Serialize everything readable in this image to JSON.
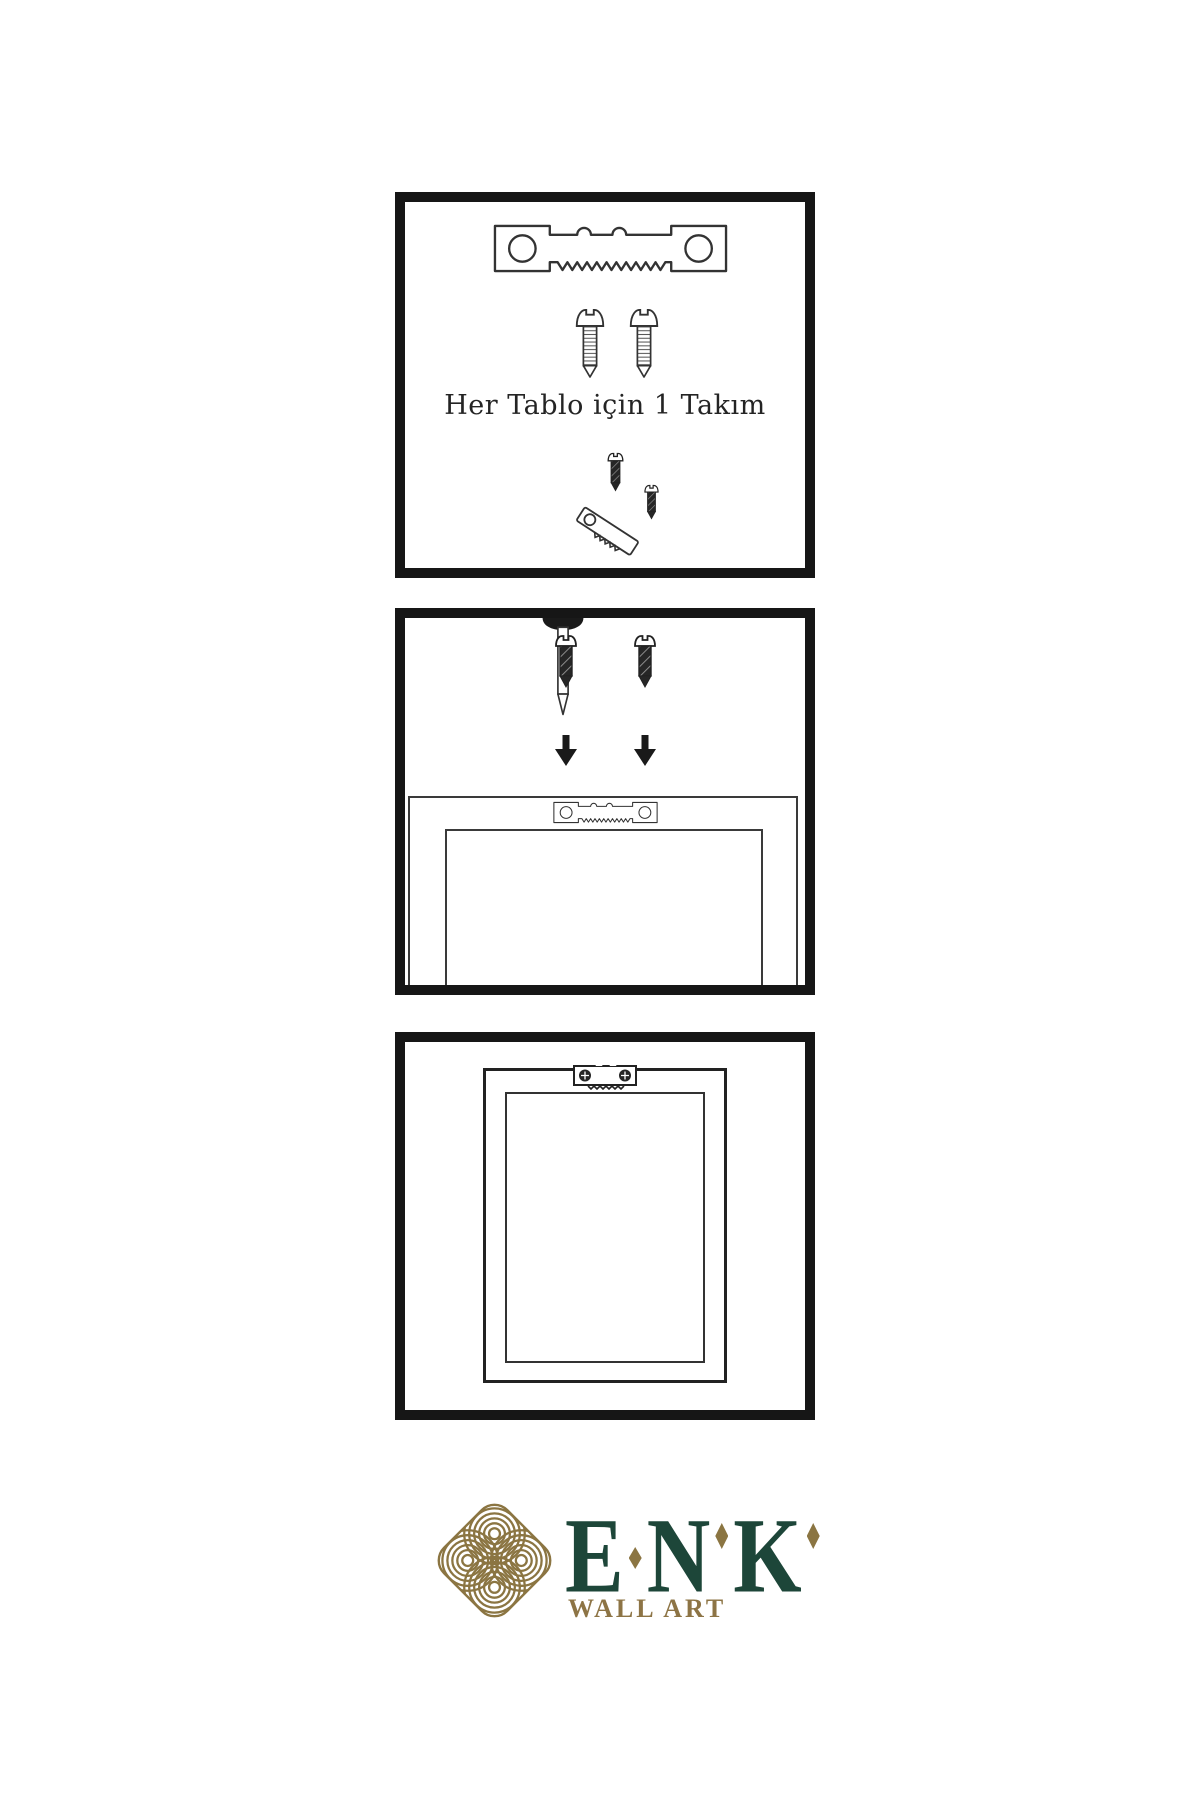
{
  "step1": {
    "caption": "Her Tablo için 1 Takım"
  },
  "brand": {
    "name": "ENK",
    "letters": [
      "E",
      "N",
      "K"
    ],
    "subtitle": "WALL ART",
    "green": "#1D4639",
    "gold": "#8B7542"
  },
  "icons": {
    "sawtooth-hanger": "sawtooth picture hanger plate with two screw holes",
    "screw": "mounting screw, side view with threads",
    "screw-dark": "screw being driven, dark shaft",
    "nail": "nail driven through wall, tip down",
    "arrow-down": "solid downward arrow",
    "frame-back": "picture frame rear view",
    "hanger-installed": "sawtooth hanger screwed onto frame",
    "knot-logo": "interlaced gold knot emblem"
  },
  "colors": {
    "background": "#FFFFFF",
    "panel_border": "#161616",
    "line": "#333333",
    "screw_dark": "#262626"
  }
}
